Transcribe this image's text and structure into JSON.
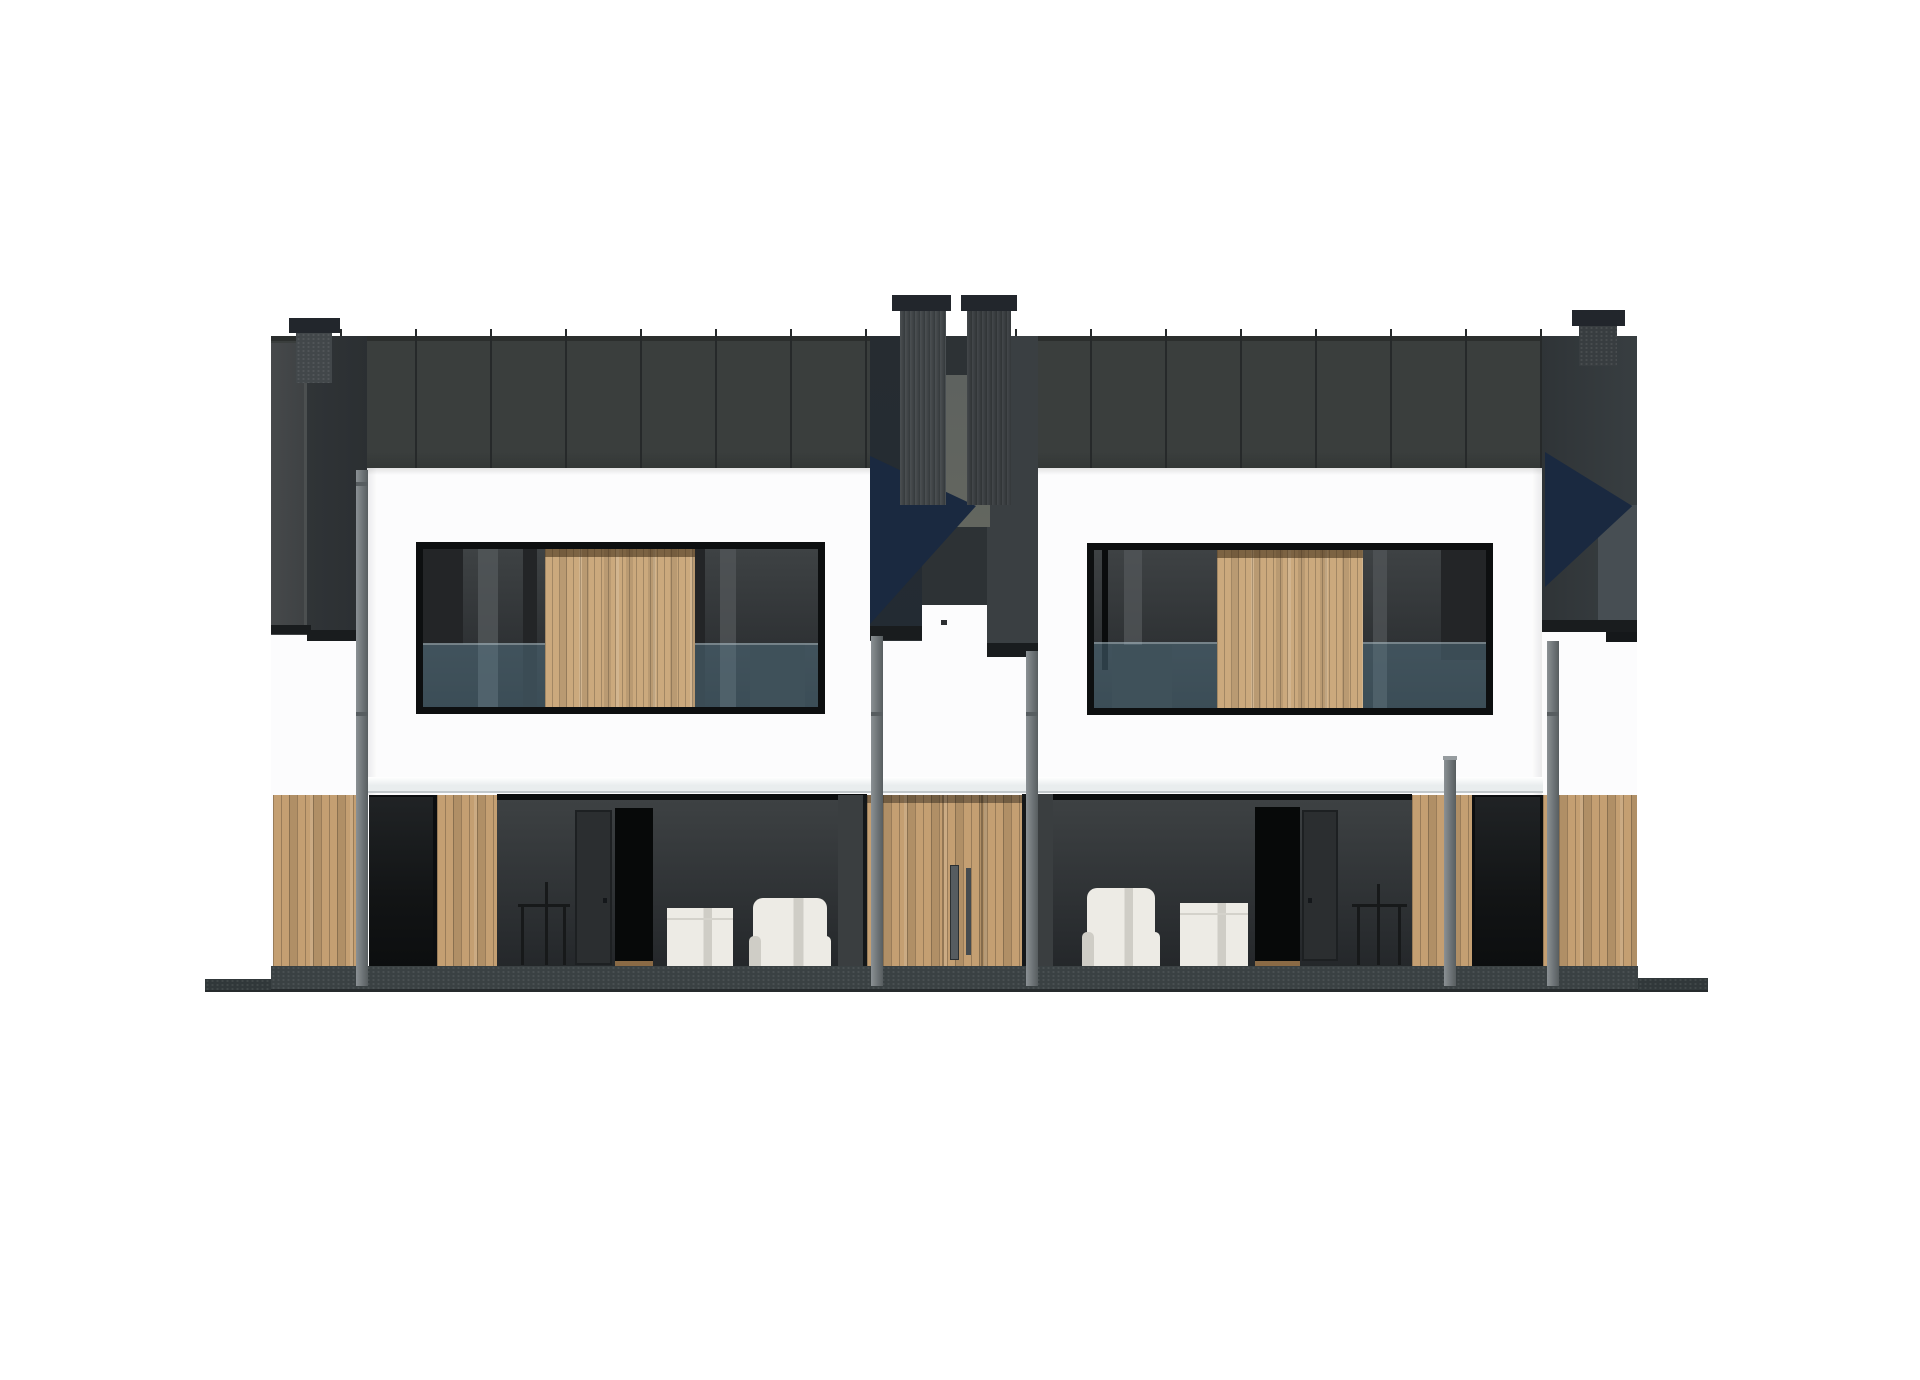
{
  "meta": {
    "description": "Photoreal architectural elevation render of a modern semi-detached twin house: dark standing-seam roof band with four chimneys, white facade, central recessed entrance niche, horizontal upper-floor windows with central wood infill panels and glass balustrades, full-height ground-floor glazing with white furniture visible inside, light oak vertical-plank cladding accents, and a dark concrete ground platform."
  },
  "colors": {
    "background": "#ffffff",
    "roof": "#3a3e3d",
    "roof_edge": "#2b2e2d",
    "roof_bottom": "#333736",
    "roof_seam": "#26292a",
    "gable_light": "#46494b",
    "gable_dark": "#303437",
    "gable_edge": "#55585a",
    "fascia": "#191c1e",
    "navy_triangle": "#1a2940",
    "wedge": "#474e53",
    "niche_base": "#2d3235",
    "niche_left": "#232b33",
    "niche_right": "#3a3f42",
    "niche_mid_light": "#63665f",
    "chimney_cap": "#22262c",
    "chimney_body": "#42474a",
    "chimney_body_dark": "#383d40",
    "wall": "#fcfcfd",
    "slab": "#e9edee",
    "slab_edge": "#c2c8cb",
    "frame": "#0d0f10",
    "glass": "#3a3d3f",
    "curtain_dark": "#232527",
    "curtain_light": "#53575a",
    "balustrade": "#587c8e",
    "wood_up_a": "#cba97d",
    "wood_lo_a": "#c49f72",
    "wood_shadow": "#6b5436",
    "glazing_top": "#3e4244",
    "glazing_bottom": "#24272a",
    "opening_dark": "#0c0e10",
    "int_door": "#2b2e30",
    "int_door_edge": "#1d2022",
    "doorway_black": "#070909",
    "sill": "#8a6a45",
    "furn_white": "#edebe5",
    "furn_shade": "#cfcdc6",
    "silhouette": "#17191a",
    "ground": "#3a4143",
    "ground_edge": "#262b2d",
    "pipe_light": "#8b9194",
    "pipe": "#6e7477",
    "pipe_dark": "#575d60",
    "handle": "#565c60",
    "handle_dark": "#454b4f",
    "dot": "#2c2f31"
  },
  "roof_seams": {
    "start_x": 340,
    "step": 75,
    "count": 17,
    "top_y": 329,
    "height": 139
  }
}
